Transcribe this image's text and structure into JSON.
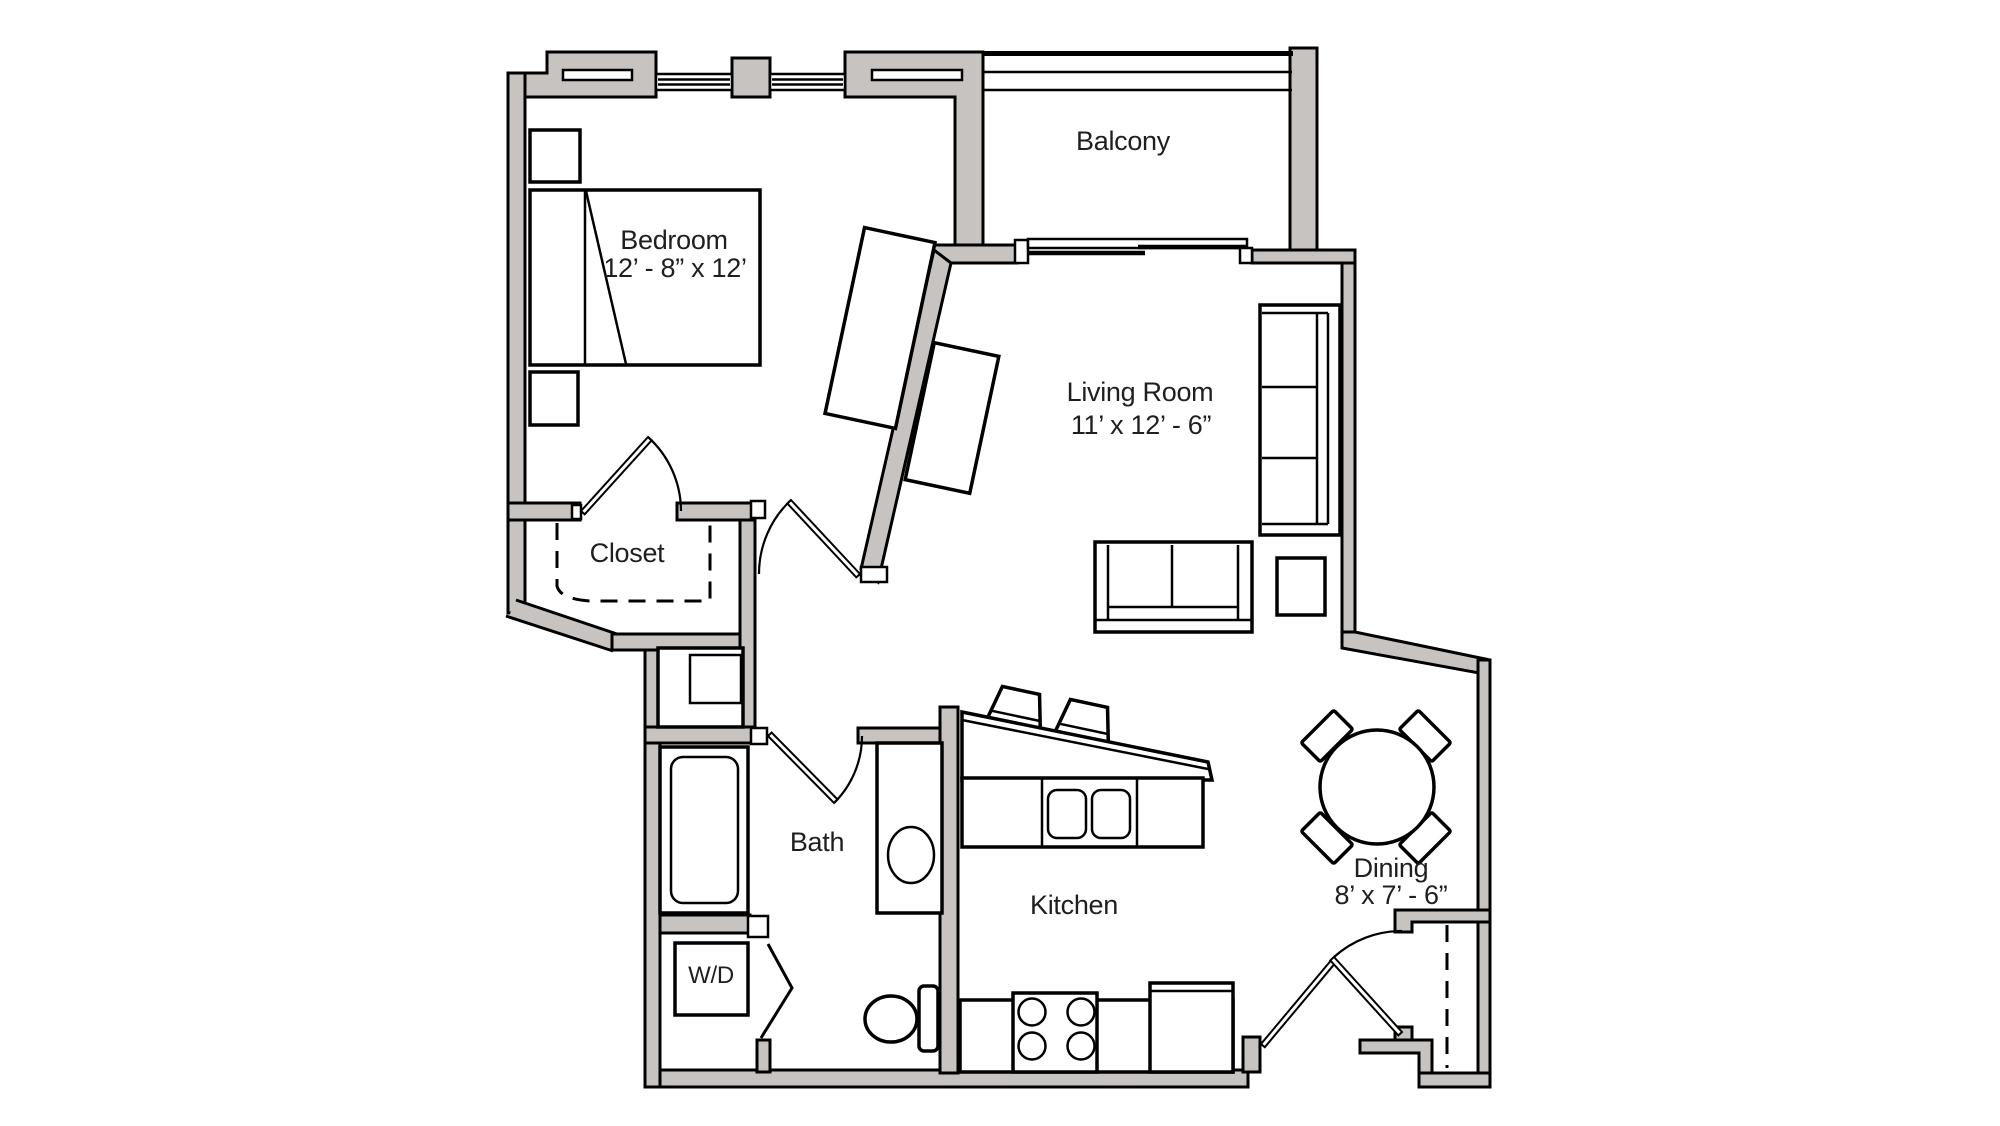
{
  "floorplan": {
    "rooms": {
      "bedroom": {
        "label": "Bedroom",
        "dimensions": "12’ - 8” x 12’"
      },
      "balcony": {
        "label": "Balcony"
      },
      "living_room": {
        "label": "Living Room",
        "dimensions": "11’ x 12’ - 6”"
      },
      "closet": {
        "label": "Closet"
      },
      "bath": {
        "label": "Bath"
      },
      "kitchen": {
        "label": "Kitchen"
      },
      "dining": {
        "label": "Dining",
        "dimensions": "8’ x 7’ - 6”"
      },
      "laundry": {
        "label": "W/D"
      }
    },
    "colors": {
      "wall_fill": "#c7c3c1",
      "line": "#000000",
      "label_color": "#1f1f1f",
      "background": "#ffffff"
    }
  }
}
